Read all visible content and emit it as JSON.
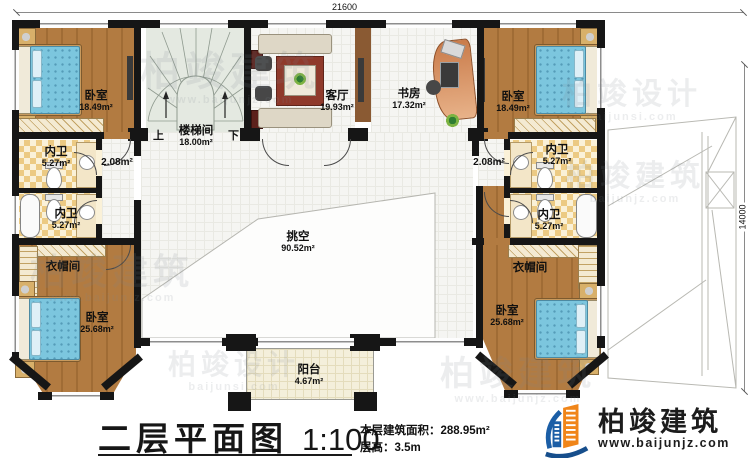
{
  "dims": {
    "width": "21600",
    "height": "14000"
  },
  "rooms": {
    "bedroom_tl": {
      "name": "卧室",
      "area": "18.49m²"
    },
    "stairwell": {
      "name": "楼梯间",
      "area": "18.00m²"
    },
    "living": {
      "name": "客厅",
      "area": "19.93m²"
    },
    "study": {
      "name": "书房",
      "area": "17.32m²"
    },
    "bedroom_tr": {
      "name": "卧室",
      "area": "18.49m²"
    },
    "bath_l1": {
      "name": "内卫",
      "area": "5.27m²"
    },
    "bath_l2": {
      "name": "内卫",
      "area": "5.27m²"
    },
    "bath_r1": {
      "name": "内卫",
      "area": "5.27m²"
    },
    "bath_r2": {
      "name": "内卫",
      "area": "5.27m²"
    },
    "corridor_l": {
      "area": "2.08m²"
    },
    "corridor_r": {
      "area": "2.08m²"
    },
    "cloak_l": {
      "name": "衣帽间"
    },
    "cloak_r": {
      "name": "衣帽间"
    },
    "bedroom_bl": {
      "name": "卧室",
      "area": "25.68m²"
    },
    "bedroom_br": {
      "name": "卧室",
      "area": "25.68m²"
    },
    "void": {
      "name": "挑空",
      "area": "90.52m²"
    },
    "balcony": {
      "name": "阳台",
      "area": "4.67m²"
    }
  },
  "stairs": {
    "up": "上",
    "down": "下"
  },
  "titleblock": {
    "title": "二层平面图",
    "scale": "1:100",
    "area_line": "本层建筑面积：288.95m²",
    "height_line": "层高：3.5m"
  },
  "logo": {
    "brand": "柏竣建筑",
    "url": "www.baijunjz.com"
  },
  "watermarks": [
    {
      "text": "柏竣建筑",
      "url": "www.baijunjz.com"
    },
    {
      "text": "柏竣设计",
      "url": "baijunsi.com"
    },
    {
      "text": "柏竣建筑",
      "url": "www.baijunjz.com"
    },
    {
      "text": "柏竣建筑",
      "url": "baijunjz.com"
    },
    {
      "text": "柏竣设计",
      "url": "baijunsi.com"
    },
    {
      "text": "柏竣建筑",
      "url": "www.baijunjz.com"
    }
  ],
  "colors": {
    "wall": "#161616",
    "wood": "#b27b41",
    "bed": "#7cc6de",
    "logo_blue": "#1b5ea6",
    "logo_orange": "#f08519"
  }
}
